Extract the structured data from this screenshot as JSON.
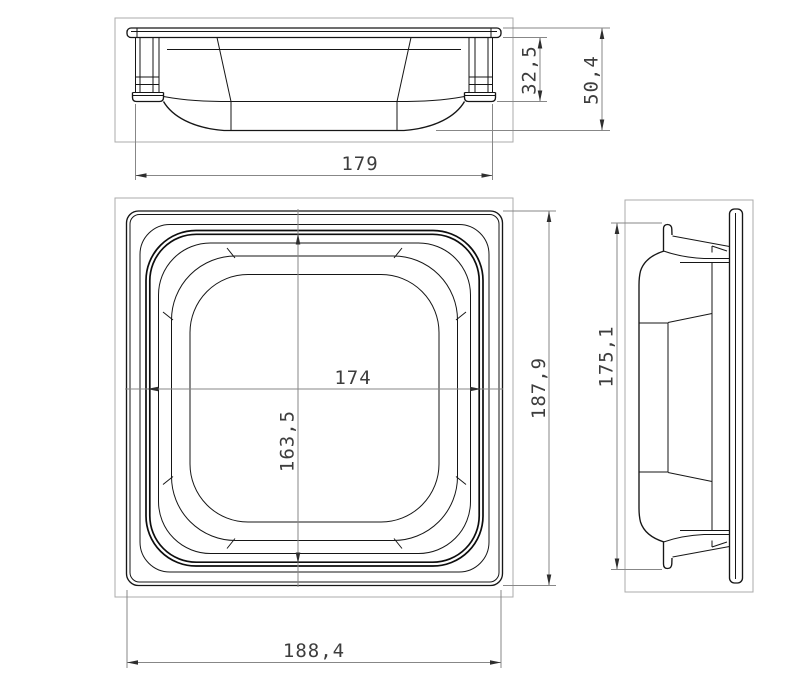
{
  "drawing": {
    "type": "technical-drawing",
    "subject": "gastronorm-pan-three-views",
    "background_color": "#ffffff",
    "line_color": "#161616",
    "dim_line_color": "#878787",
    "frame_color": "#ababab",
    "text_color": "#3d3d3d",
    "views": {
      "front": {
        "name": "front-elevation",
        "dims": {
          "width": "179",
          "rim_height": "32,5",
          "overall_height": "50,4"
        }
      },
      "plan": {
        "name": "top-plan",
        "dims": {
          "opening_width": "174",
          "opening_depth": "163,5",
          "overall_depth": "187,9",
          "overall_width": "188,4"
        }
      },
      "side": {
        "name": "side-elevation",
        "dims": {
          "flange_height": "175,1"
        }
      }
    }
  }
}
